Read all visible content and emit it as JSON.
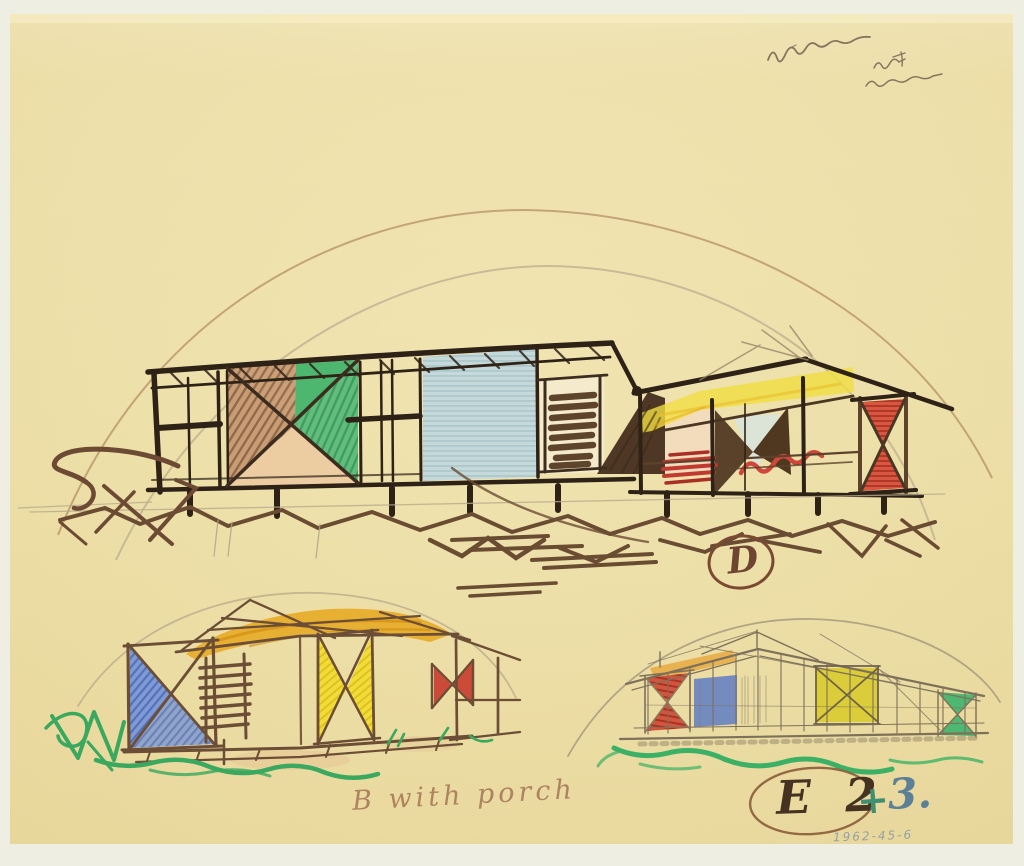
{
  "artwork": {
    "type": "scanned hand drawing",
    "description": "Three sketch studies of low post-and-beam houses with colored X-braced panels, drawn in dark marker, colored pencil and graphite on cream tracing paper; large perspective above, two smaller studies below, framed by large elliptical guide arcs",
    "paper_color": "#f0e2ac",
    "scan_background": "#efeee3"
  },
  "inscriptions": {
    "top_right_note": {
      "text": "illegible cursive graphite inscription, two lines (name and note)",
      "color": "#756452"
    },
    "label_d": {
      "text": "D",
      "style": "circled in brown",
      "color": "#6d4531"
    },
    "caption_b": {
      "text": "B with porch",
      "color": "#a06f50"
    },
    "label_e2": {
      "text": "E 2",
      "style": "circled in brown",
      "color": "#463220"
    },
    "label_plus": {
      "text": "+",
      "color": "#3f8f70"
    },
    "label_three": {
      "text": "3.",
      "color": "#5c8095"
    },
    "accession_number": {
      "text": "1962-45-6",
      "color": "#8b9aa6"
    }
  },
  "sketches": {
    "house_d": {
      "label": "D",
      "position": "upper center",
      "features": "long house on stilts; brown/green X panel, blue hatched wall, louvers, yellow ceiling, red X end panel, red scribbles, brown ground scribbles and tree gesture"
    },
    "house_b": {
      "label": "B with porch",
      "position": "lower left",
      "features": "small pavilion with orange canopy, blue X panel, ladder, yellow X panel, small red X porch, green grass scribbles"
    },
    "house_e": {
      "label": "E 2 + 3.",
      "position": "lower right",
      "features": "long graphite elevation with red, blue, yellow and green panels over green grass scribble"
    }
  },
  "palette": {
    "dark_marker": "#2e2217",
    "ground_brown": "#6a4c33",
    "peach": "#ecca9f",
    "green": "#43b26c",
    "wall_blue": "#c3d8dc",
    "red": "#c64434",
    "yellow": "#f0de41",
    "orange_canopy": "#e8a81f",
    "pencil_blue": "#5c80c8",
    "pencil_yellow": "#f1d92b",
    "graphite": "#7e715a",
    "grass_green": "#3aa85e"
  }
}
